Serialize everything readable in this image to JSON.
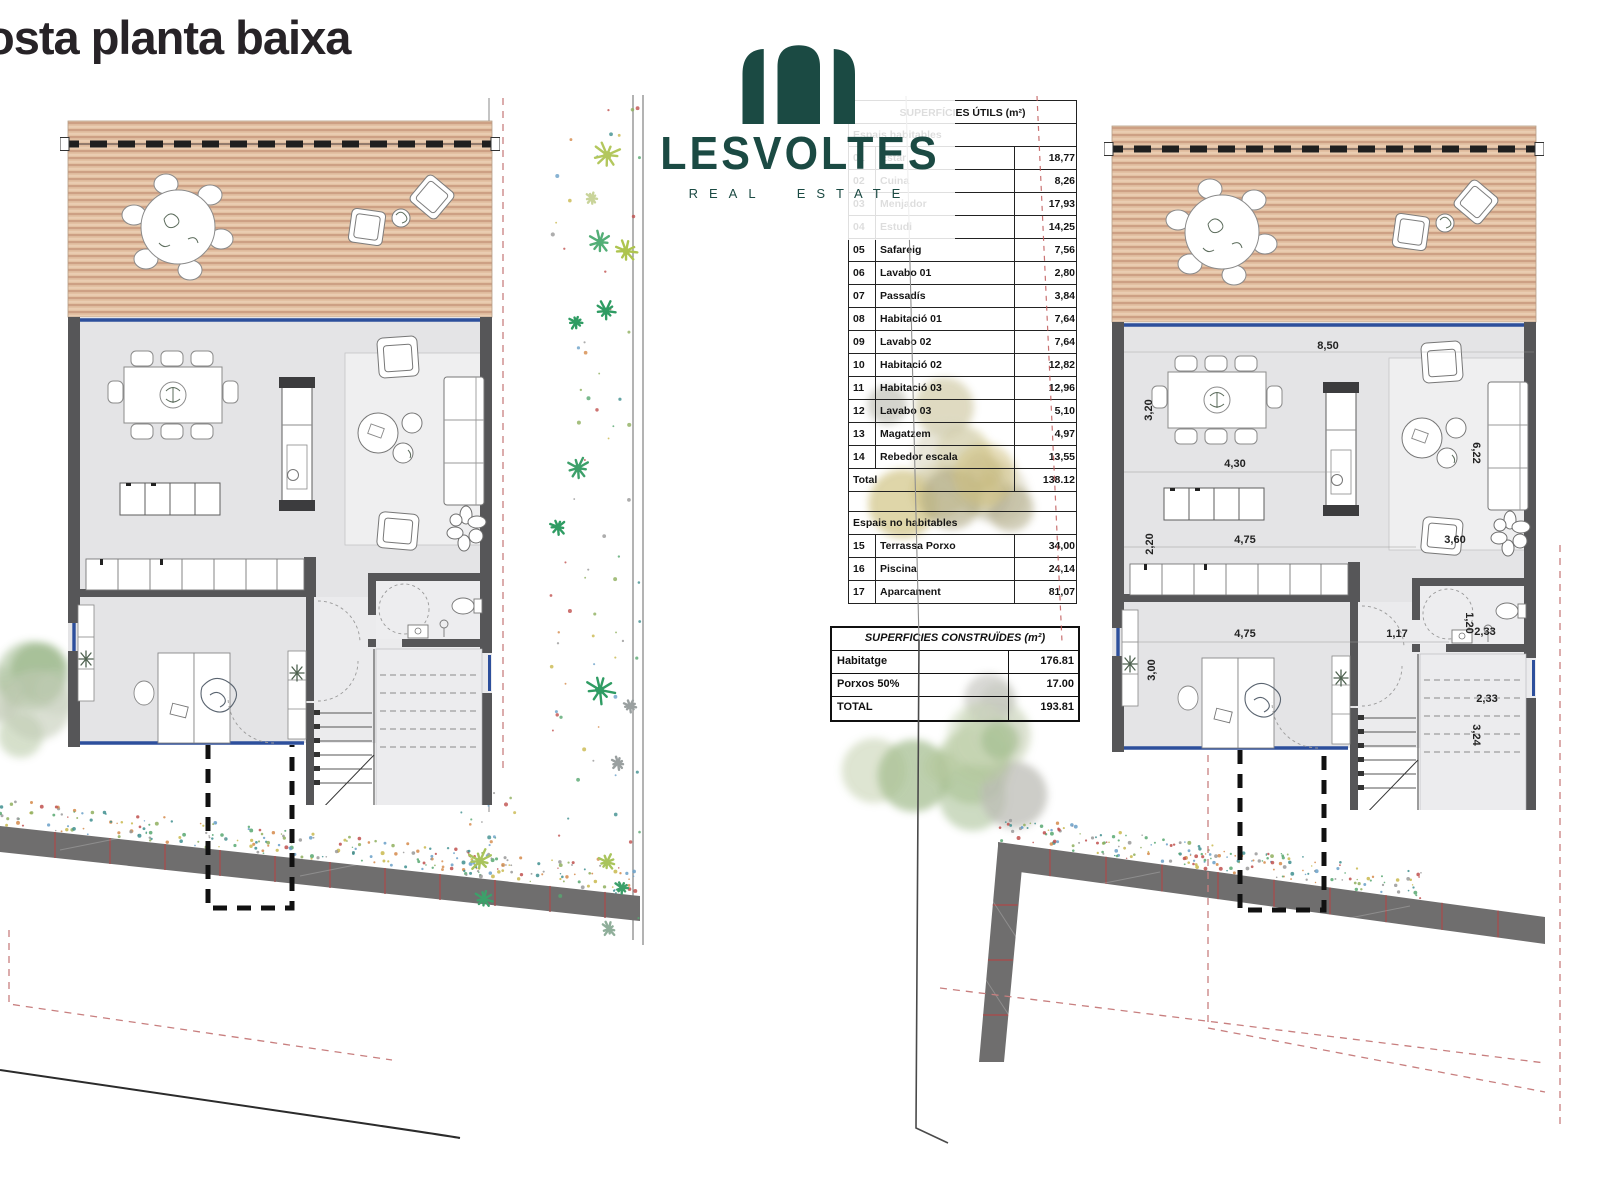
{
  "title": "osta planta baixa",
  "logo": {
    "name": "LESVOLTES",
    "tagline": "REAL ESTATE",
    "color": "#1b4a43"
  },
  "useful_areas_table": {
    "title": "SUPERFÍCIES ÚTILS (m²)",
    "section1_label": "Espais habitables",
    "rows": [
      {
        "num": "01",
        "label": "Estar",
        "value": "18,77"
      },
      {
        "num": "02",
        "label": "Cuina",
        "value": "8,26"
      },
      {
        "num": "03",
        "label": "Menjador",
        "value": "17,93"
      },
      {
        "num": "04",
        "label": "Estudi",
        "value": "14,25"
      },
      {
        "num": "05",
        "label": "Safareig",
        "value": "7,56"
      },
      {
        "num": "06",
        "label": "Lavabo 01",
        "value": "2,80"
      },
      {
        "num": "07",
        "label": "Passadís",
        "value": "3,84"
      },
      {
        "num": "08",
        "label": "Habitació 01",
        "value": "7,64"
      },
      {
        "num": "09",
        "label": "Lavabo 02",
        "value": "7,64"
      },
      {
        "num": "10",
        "label": "Habitació 02",
        "value": "12,82"
      },
      {
        "num": "11",
        "label": "Habitació 03",
        "value": "12,96"
      },
      {
        "num": "12",
        "label": "Lavabo 03",
        "value": "5,10"
      },
      {
        "num": "13",
        "label": "Magatzem",
        "value": "4,97"
      },
      {
        "num": "14",
        "label": "Rebedor escala",
        "value": "13,55"
      }
    ],
    "total_label": "Total",
    "total_value": "138.12",
    "section2_label": "Espais no habitables",
    "rows2": [
      {
        "num": "15",
        "label": "Terrassa Porxo",
        "value": "34,00"
      },
      {
        "num": "16",
        "label": "Piscina",
        "value": "24,14"
      },
      {
        "num": "17",
        "label": "Aparcament",
        "value": "81,07"
      }
    ]
  },
  "built_areas_table": {
    "title": "SUPERFICIES CONSTRUÏDES (m²)",
    "rows": [
      {
        "label": "Habitatge",
        "value": "176.81"
      },
      {
        "label": "Porxos 50%",
        "value": "17.00"
      },
      {
        "label": "TOTAL",
        "value": "193.81"
      }
    ]
  },
  "dims": [
    "8,50",
    "3,20",
    "4,30",
    "2,20",
    "4,75",
    "3,60",
    "6,22",
    "4,75",
    "1,17",
    "3,00",
    "1,20",
    "2,33",
    "2,33",
    "3,24"
  ],
  "colors": {
    "logo_teal": "#1b4a43",
    "glass_blue": "#2d4f9c",
    "deck_tan": "#e3c1a3",
    "wall_grey": "#565658",
    "site_wall_grey": "#6f6e6e",
    "joint_red": "#a34f4f",
    "property_line_red": "#c87f7f"
  }
}
